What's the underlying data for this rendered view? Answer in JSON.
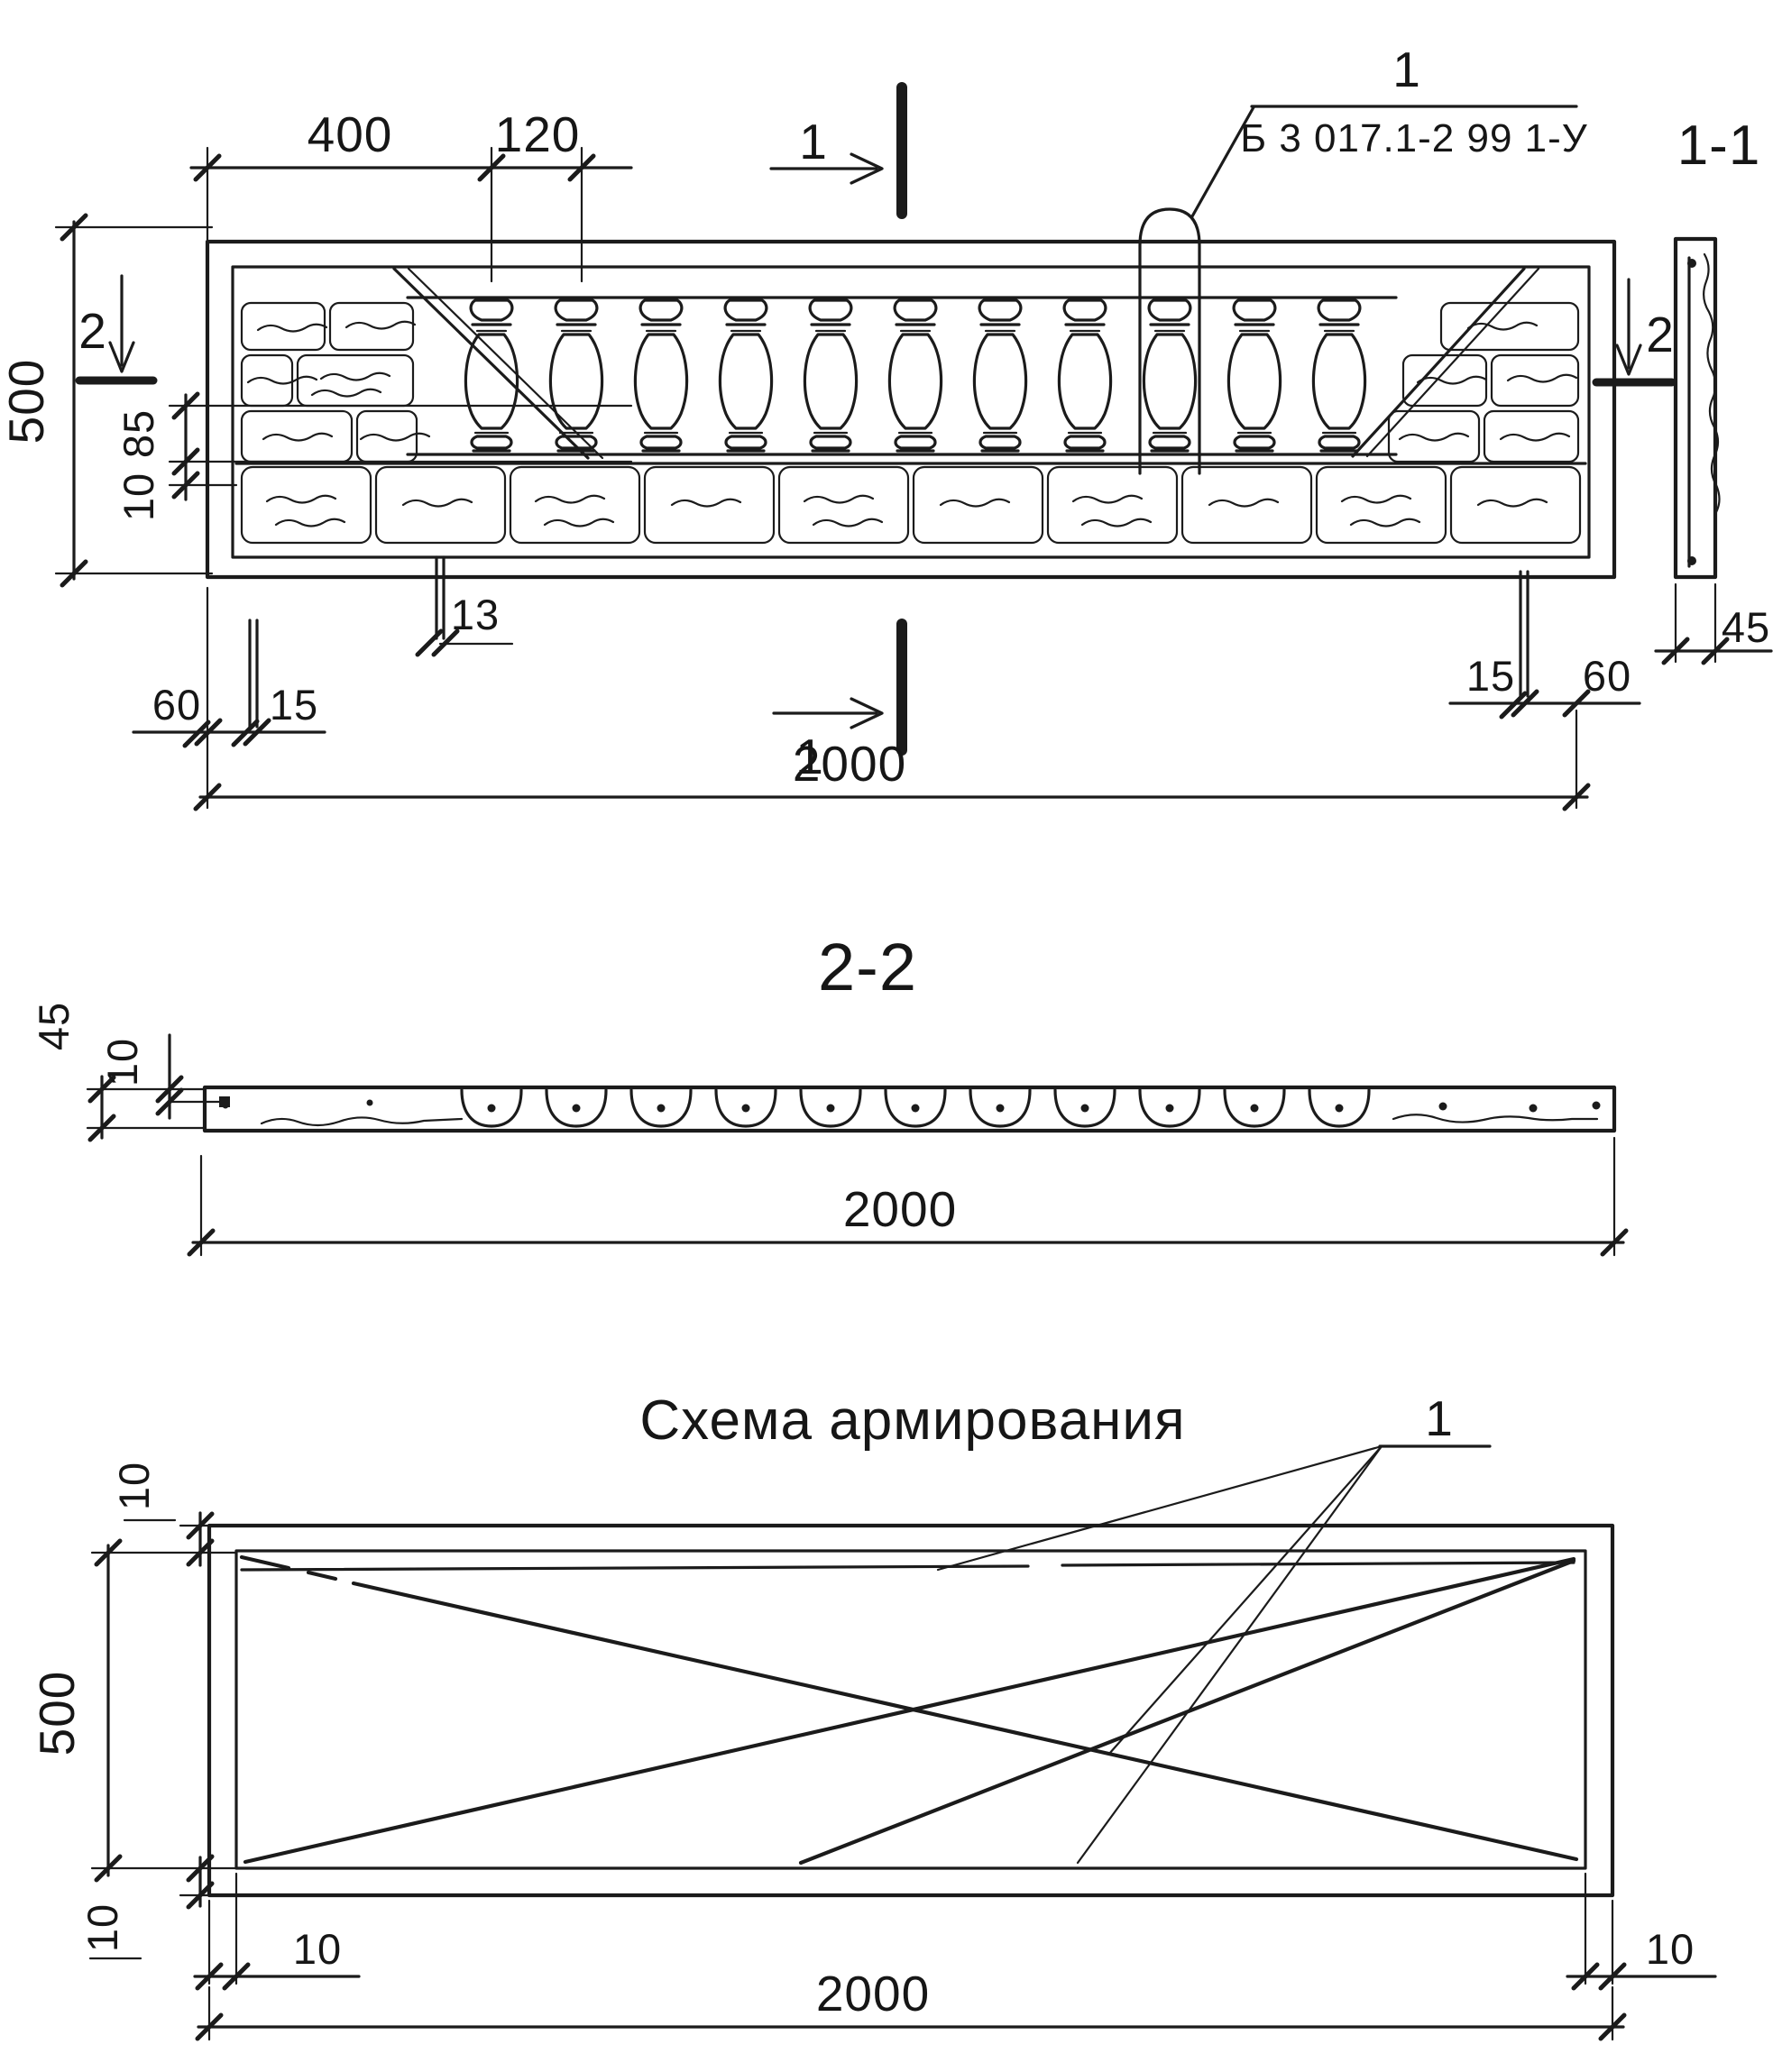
{
  "colors": {
    "ink": "#1b1b1b",
    "paper": "#ffffff"
  },
  "elevation": {
    "dim_top_400": "400",
    "dim_top_120": "120",
    "section_mark_1_top": "1",
    "section_mark_1_bottom": "1",
    "section_mark_2_left": "2",
    "section_mark_2_right": "2",
    "callout_number": "1",
    "callout_code": "Б 3 017.1-2 99 1-У",
    "side_view_title": "1-1",
    "dim_height_500": "500",
    "dim_85": "85",
    "dim_10": "10",
    "dim_13": "13",
    "dim_60_left": "60",
    "dim_15_left": "15",
    "dim_15_right": "15",
    "dim_60_right": "60",
    "dim_45_side": "45",
    "dim_length_2000": "2000"
  },
  "section_2_2": {
    "title": "2-2",
    "dim_45": "45",
    "dim_10": "10",
    "dim_2000": "2000"
  },
  "reinforcement": {
    "title": "Схема армирования",
    "callout_number": "1",
    "dim_10_top_left": "10",
    "dim_500": "500",
    "dim_10_bottom_left_rot": "10",
    "dim_10_bottom_left": "10",
    "dim_10_bottom_right": "10",
    "dim_2000": "2000"
  }
}
